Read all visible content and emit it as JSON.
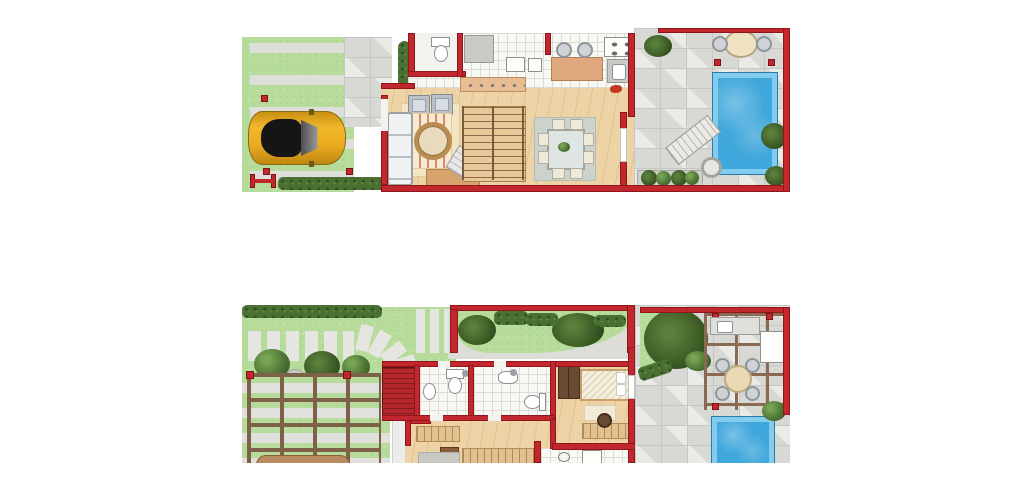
{
  "meta": {
    "description": "Illustrated top-down floor plans of a two-storey house, stacked vertically on a white background. No text labels are rendered in the image.",
    "plan_count": 2
  },
  "palette": {
    "background": "#ffffff",
    "wall_red": "#c1272d",
    "wall_outline": "#7e1216",
    "wood_floor": "#eed3a7",
    "tile_floor": "#f8f8f5",
    "grass": "#b7db9b",
    "pavers": "#d8d8d4",
    "pool_water": "#3fa7db",
    "pool_edge": "#84ccee",
    "hedge_green": "#4a6f33",
    "pergola_beam": "#7d6148",
    "car_body": "#e8a821",
    "rug_beige": "#f3e5c3",
    "rug_gray": "#ccd3cc",
    "stair_red": "#b6272b"
  },
  "plans": [
    {
      "id": "ground-floor",
      "position": "top",
      "areas": [
        "front-lawn-with-paving-strips",
        "parked-car",
        "entry-walkway",
        "small-bathroom",
        "kitchen-with-breakfast-bar",
        "living-room",
        "central-staircase",
        "dining-room",
        "rear-terrace",
        "swimming-pool",
        "sun-lounger",
        "outdoor-table",
        "planter-box"
      ]
    },
    {
      "id": "upper-floor",
      "position": "bottom",
      "areas": [
        "garden-with-stepping-stones",
        "pergola-over-lawn",
        "red-outdoor-stairs",
        "bathroom-1",
        "bathroom-2",
        "bedroom-with-bed-and-desk",
        "lower-bedroom-cropped",
        "utility-room-cropped",
        "rear-terrace",
        "pergola-dining-with-outdoor-kitchen",
        "large-tree",
        "swimming-pool-cropped"
      ]
    }
  ]
}
